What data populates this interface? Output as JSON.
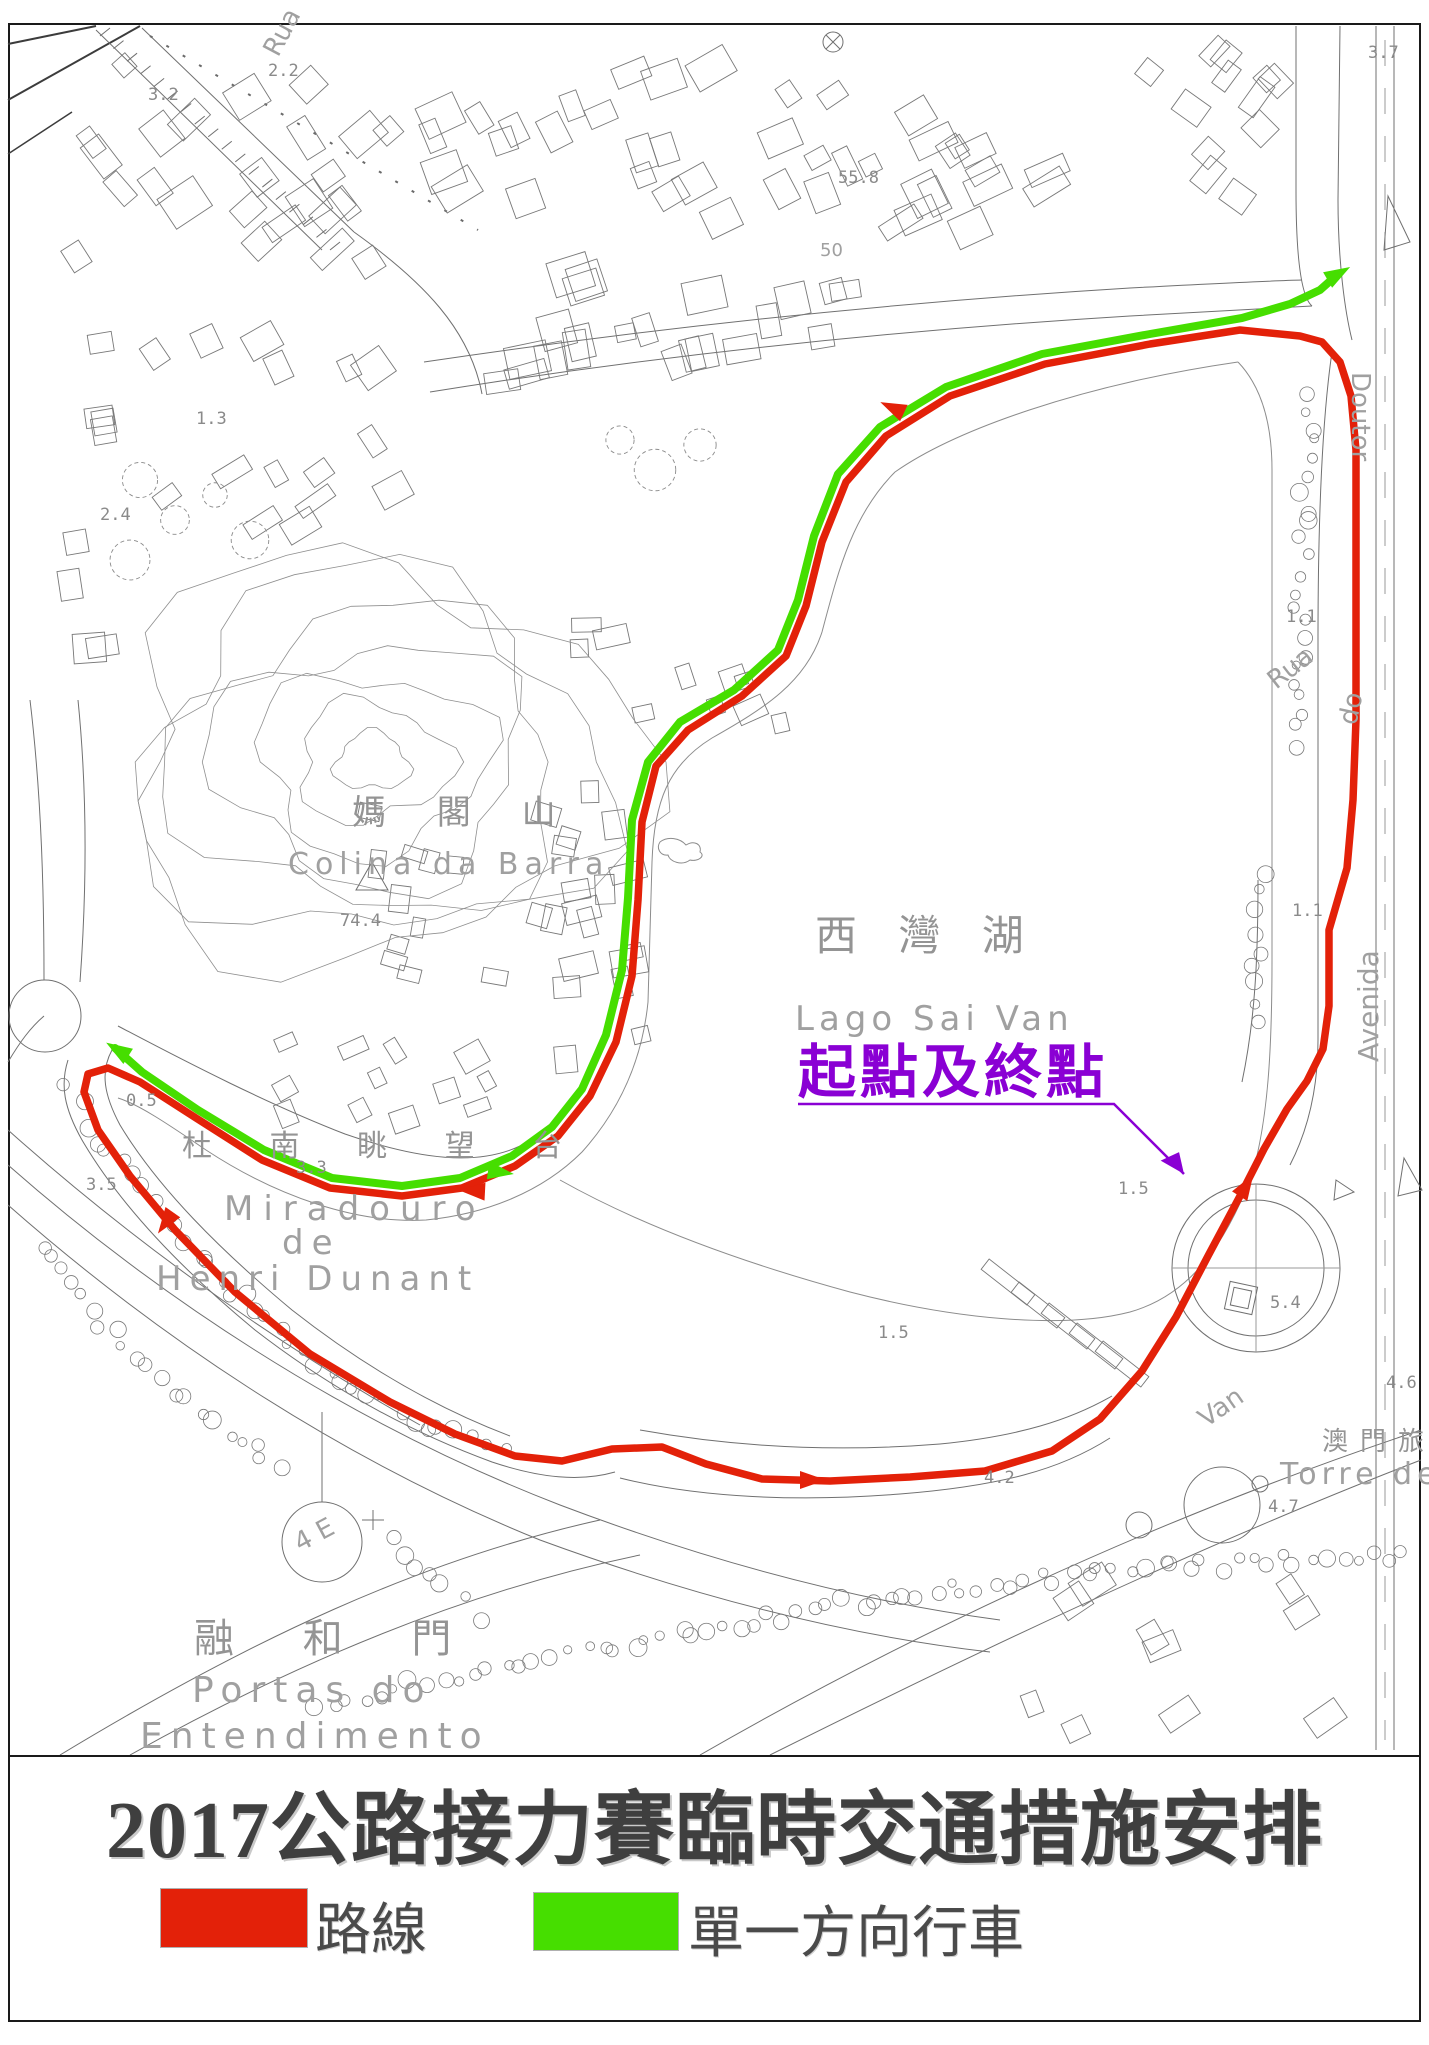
{
  "title": {
    "text": "2017公路接力賽臨時交通措施安排"
  },
  "legend": {
    "items": [
      {
        "label": "路線",
        "color": "#e32109"
      },
      {
        "label": "單一方向行車",
        "color": "#46de00"
      }
    ]
  },
  "map": {
    "colors": {
      "route": "#e32109",
      "oneway": "#46de00",
      "annotation": "#8a00d4",
      "linework": "#707070",
      "label_gray": "#949494"
    },
    "labels": {
      "lake_zh": "西 灣 湖",
      "lake_pt": "Lago Sai Van",
      "start_finish": "起點及終點",
      "hill_zh": "媽 閣 山",
      "hill_pt": "Colina da Barra",
      "lookout_zh": "杜 南 眺 望 台",
      "miradouro_line1": "Miradouro",
      "miradouro_line2": "de",
      "miradouro_line3": "Henri Dunant",
      "gates_zh": "融 和 門",
      "gates_pt_line1": "Portas do",
      "gates_pt_line2": "Entendimento",
      "tower_zh": "澳門旅遊塔",
      "tower_pt": "Torre de Macau",
      "street_rua_top": "Rua",
      "street_doutor": "Doutor",
      "street_rua_right": "Rua",
      "street_do": "do",
      "street_avenida": "Avenida",
      "street_van": "Van",
      "lamp_symbol": "4 E",
      "contour_50": "50"
    },
    "elevations": [
      {
        "v": "3.2",
        "x": 148,
        "y": 100
      },
      {
        "v": "2.2",
        "x": 268,
        "y": 76
      },
      {
        "v": "55.8",
        "x": 838,
        "y": 183
      },
      {
        "v": "3.7",
        "x": 1368,
        "y": 58
      },
      {
        "v": "1.3",
        "x": 196,
        "y": 424
      },
      {
        "v": "2.4",
        "x": 100,
        "y": 520
      },
      {
        "v": "74.4",
        "x": 340,
        "y": 926
      },
      {
        "v": "0.5",
        "x": 126,
        "y": 1106
      },
      {
        "v": "3.5",
        "x": 86,
        "y": 1190
      },
      {
        "v": "3.3",
        "x": 296,
        "y": 1173
      },
      {
        "v": "1.1",
        "x": 1286,
        "y": 622
      },
      {
        "v": "1.1",
        "x": 1292,
        "y": 916
      },
      {
        "v": "1.5",
        "x": 1118,
        "y": 1194
      },
      {
        "v": "1.5",
        "x": 878,
        "y": 1338
      },
      {
        "v": "4.2",
        "x": 984,
        "y": 1483
      },
      {
        "v": "5.4",
        "x": 1270,
        "y": 1308
      },
      {
        "v": "4.7",
        "x": 1268,
        "y": 1512
      },
      {
        "v": "4.6",
        "x": 1386,
        "y": 1388
      }
    ],
    "routes": {
      "race": {
        "closed": true,
        "points": [
          [
            1300,
            336
          ],
          [
            1240,
            330
          ],
          [
            1150,
            344
          ],
          [
            1045,
            364
          ],
          [
            950,
            396
          ],
          [
            886,
            436
          ],
          [
            846,
            482
          ],
          [
            822,
            542
          ],
          [
            806,
            606
          ],
          [
            786,
            656
          ],
          [
            742,
            696
          ],
          [
            688,
            730
          ],
          [
            656,
            766
          ],
          [
            642,
            822
          ],
          [
            638,
            900
          ],
          [
            632,
            976
          ],
          [
            616,
            1042
          ],
          [
            590,
            1096
          ],
          [
            558,
            1136
          ],
          [
            515,
            1166
          ],
          [
            462,
            1188
          ],
          [
            402,
            1196
          ],
          [
            330,
            1188
          ],
          [
            262,
            1160
          ],
          [
            196,
            1118
          ],
          [
            140,
            1082
          ],
          [
            108,
            1068
          ],
          [
            88,
            1074
          ],
          [
            84,
            1092
          ],
          [
            98,
            1130
          ],
          [
            130,
            1176
          ],
          [
            175,
            1230
          ],
          [
            235,
            1292
          ],
          [
            310,
            1354
          ],
          [
            390,
            1402
          ],
          [
            455,
            1434
          ],
          [
            515,
            1456
          ],
          [
            562,
            1461
          ],
          [
            612,
            1449
          ],
          [
            662,
            1447
          ],
          [
            706,
            1464
          ],
          [
            762,
            1479
          ],
          [
            830,
            1481
          ],
          [
            910,
            1477
          ],
          [
            985,
            1471
          ],
          [
            1052,
            1451
          ],
          [
            1100,
            1419
          ],
          [
            1142,
            1371
          ],
          [
            1176,
            1317
          ],
          [
            1208,
            1256
          ],
          [
            1240,
            1196
          ],
          [
            1264,
            1149
          ],
          [
            1287,
            1109
          ],
          [
            1307,
            1081
          ],
          [
            1323,
            1049
          ],
          [
            1329,
            1006
          ],
          [
            1329,
            930
          ],
          [
            1347,
            868
          ],
          [
            1353,
            800
          ],
          [
            1356,
            720
          ],
          [
            1356,
            560
          ],
          [
            1356,
            450
          ],
          [
            1351,
            396
          ],
          [
            1340,
            362
          ],
          [
            1322,
            342
          ]
        ],
        "arrows": [
          {
            "x": 893,
            "y": 408,
            "a": 205
          },
          {
            "x": 473,
            "y": 1191,
            "a": 183
          },
          {
            "x": 166,
            "y": 1222,
            "a": 125
          },
          {
            "x": 812,
            "y": 1480,
            "a": 0
          },
          {
            "x": 1246,
            "y": 1186,
            "a": -58
          }
        ]
      },
      "oneway": {
        "closed": false,
        "points": [
          [
            115,
            1048
          ],
          [
            142,
            1072
          ],
          [
            198,
            1110
          ],
          [
            264,
            1150
          ],
          [
            332,
            1178
          ],
          [
            402,
            1186
          ],
          [
            460,
            1178
          ],
          [
            512,
            1156
          ],
          [
            552,
            1127
          ],
          [
            582,
            1089
          ],
          [
            606,
            1035
          ],
          [
            622,
            970
          ],
          [
            628,
            898
          ],
          [
            632,
            820
          ],
          [
            648,
            762
          ],
          [
            680,
            722
          ],
          [
            734,
            690
          ],
          [
            778,
            650
          ],
          [
            798,
            600
          ],
          [
            814,
            536
          ],
          [
            838,
            474
          ],
          [
            880,
            427
          ],
          [
            946,
            387
          ],
          [
            1042,
            354
          ],
          [
            1150,
            334
          ],
          [
            1242,
            318
          ],
          [
            1290,
            304
          ],
          [
            1320,
            290
          ],
          [
            1338,
            274
          ]
        ],
        "arrows": [
          {
            "x": 1338,
            "y": 274,
            "a": -30
          },
          {
            "x": 500,
            "y": 1172,
            "a": 8
          },
          {
            "x": 118,
            "y": 1050,
            "a": 212
          }
        ]
      }
    },
    "annotation": {
      "leader": [
        [
          798,
          1104
        ],
        [
          1114,
          1104
        ],
        [
          1184,
          1174
        ]
      ],
      "arrow": {
        "x": 1184,
        "y": 1174,
        "a": 45
      }
    }
  }
}
